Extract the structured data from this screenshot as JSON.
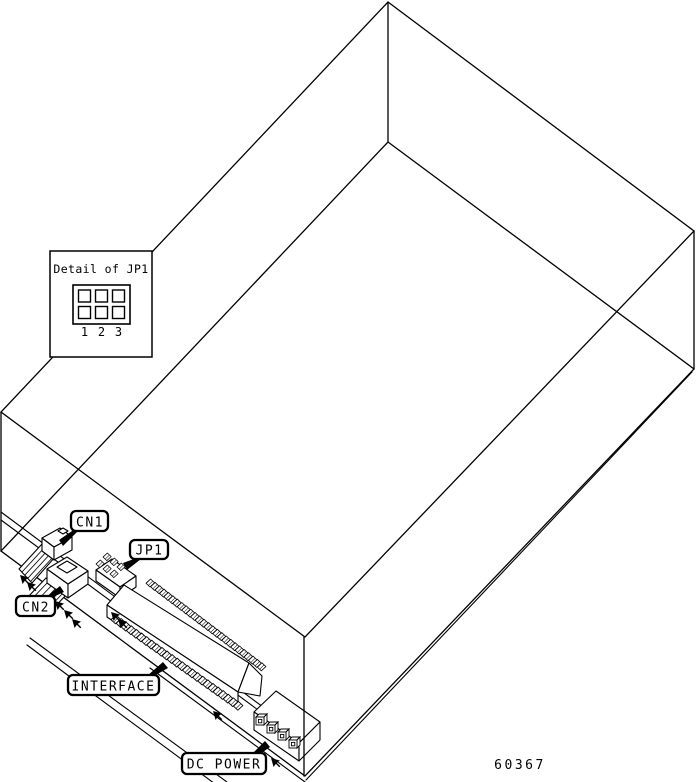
{
  "figure": {
    "colors": {
      "line": "#000000",
      "background": "#ffffff"
    },
    "inset": {
      "title": "Detail of JP1",
      "pins": [
        "1",
        "2",
        "3"
      ]
    },
    "labels": {
      "cn1": "CN1",
      "cn2": "CN2",
      "jp1": "JP1",
      "interface": "INTERFACE",
      "dc_power": "DC POWER"
    },
    "figure_number": "60367"
  }
}
